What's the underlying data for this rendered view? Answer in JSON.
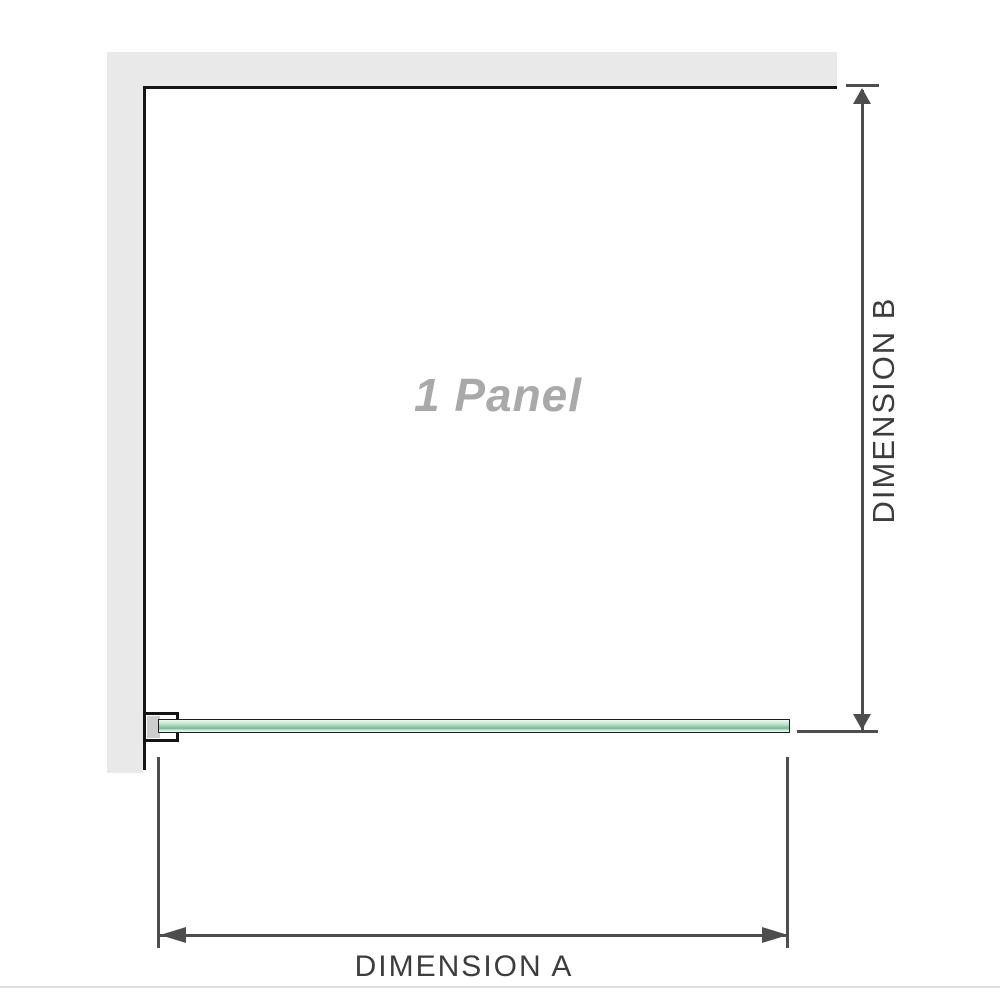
{
  "panel": {
    "label": "1 Panel"
  },
  "dimensions": {
    "a": {
      "label": "DIMENSION A",
      "orientation": "horizontal"
    },
    "b": {
      "label": "DIMENSION B",
      "orientation": "vertical"
    }
  },
  "colors": {
    "wall": "#e9e9e9",
    "bracket_pad": "#cdcdcd",
    "outline": "#161616",
    "dimension_line": "#4d4d4d",
    "glass_green_light": "#e8f7ef",
    "glass_green_dark": "#79b493",
    "panel_label_text": "#a9a9a9",
    "dimension_label_text": "#3d3d3d",
    "footer_rule": "#dcdfdb"
  },
  "icons": {
    "arrow_up": "css-triangle-up",
    "arrow_down": "css-triangle-down",
    "arrow_left": "css-triangle-left",
    "arrow_right": "css-triangle-right"
  }
}
